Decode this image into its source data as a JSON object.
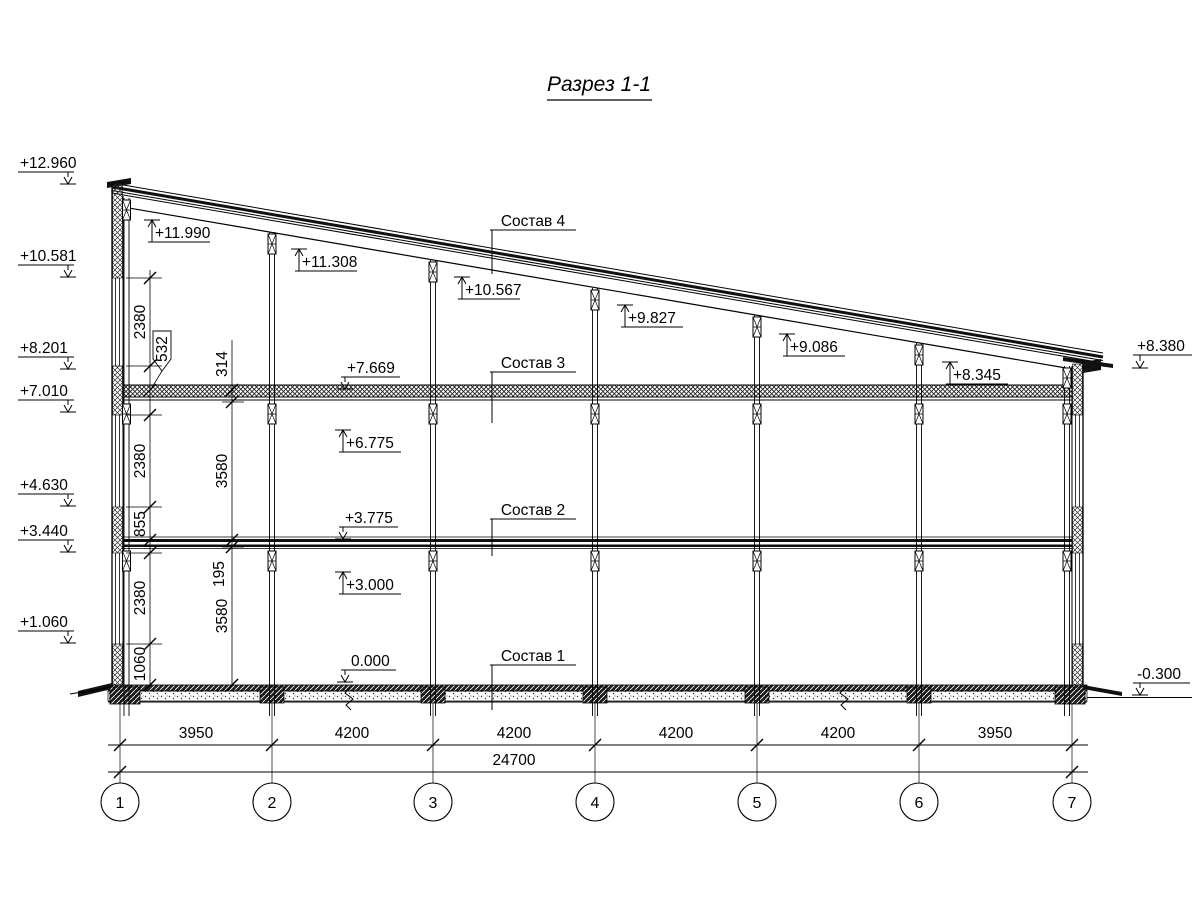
{
  "title": "Разрез 1-1",
  "marks": {
    "left": [
      "+12.960",
      "+10.581",
      "+8.201",
      "+7.010",
      "+4.630",
      "+3.440",
      "+1.060"
    ],
    "right": [
      "+8.380",
      "-0.300"
    ],
    "roof": [
      "+11.990",
      "+11.308",
      "+10.567",
      "+9.827",
      "+9.086",
      "+8.345"
    ],
    "floors": {
      "s3_top": "+7.669",
      "s3_mid": "+6.775",
      "s2_top": "+3.775",
      "s2_mid": "+3.000",
      "zero": "0.000"
    }
  },
  "layers": [
    "Состав 4",
    "Состав 3",
    "Состав 2",
    "Состав 1"
  ],
  "vdims": {
    "chain1": [
      "2380",
      "532",
      "2380",
      "855",
      "2380",
      "1060"
    ],
    "chain2": [
      "314",
      "3580",
      "195",
      "3580"
    ]
  },
  "hdims": {
    "segments": [
      "3950",
      "4200",
      "4200",
      "4200",
      "4200",
      "3950"
    ],
    "total": "24700"
  },
  "grid": [
    "1",
    "2",
    "3",
    "4",
    "5",
    "6",
    "7"
  ]
}
